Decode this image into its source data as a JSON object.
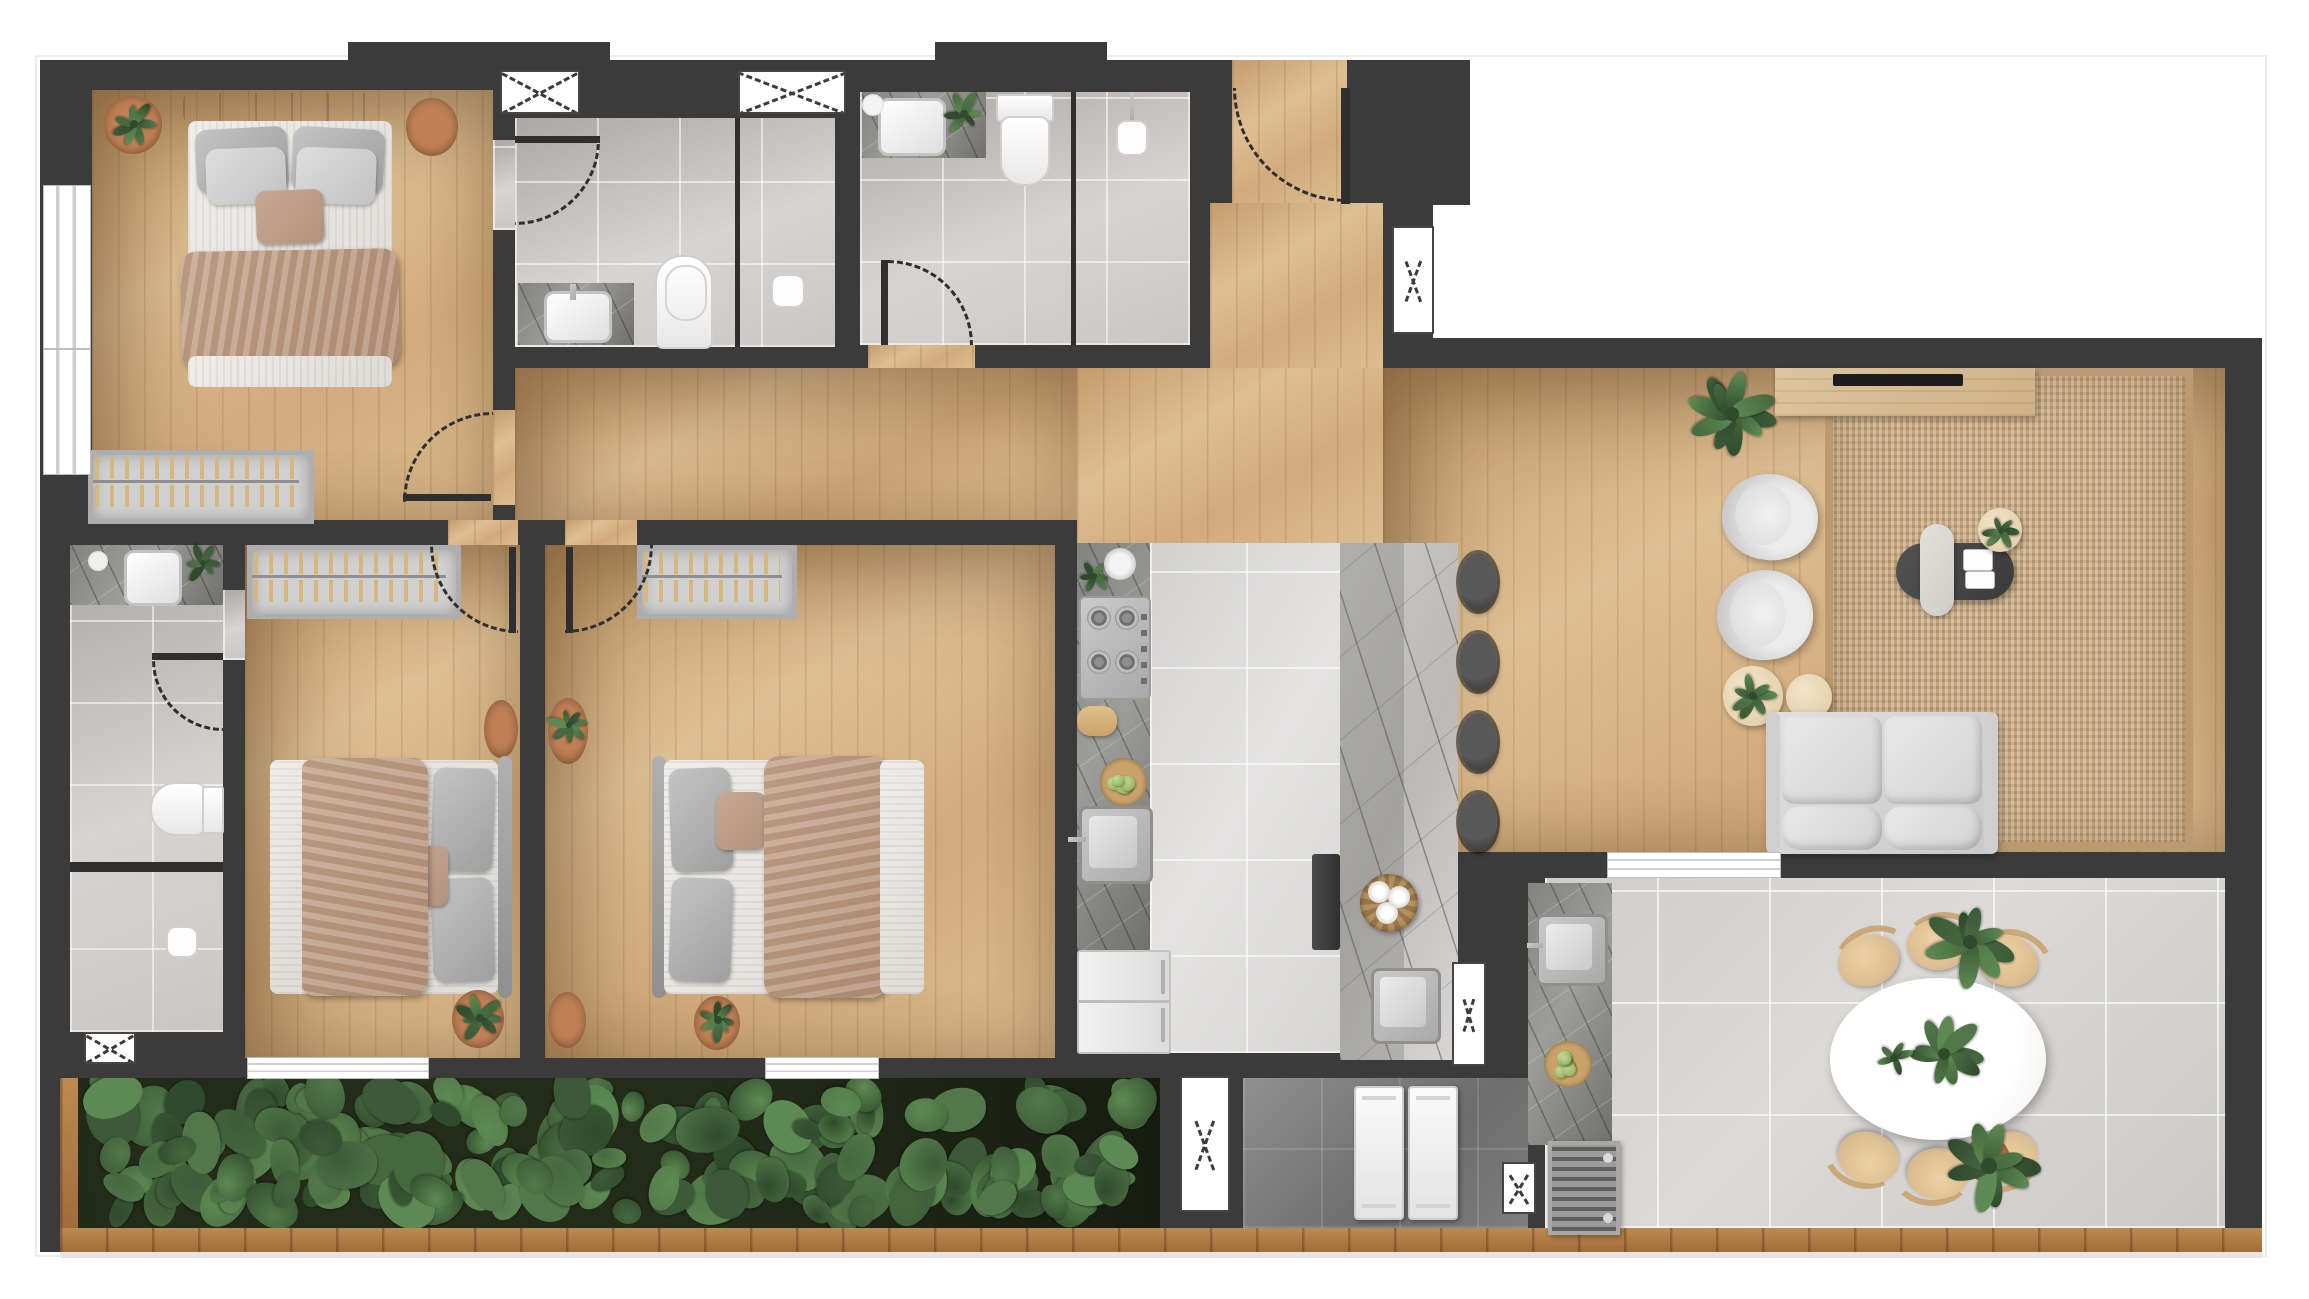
{
  "canvas": {
    "width": 2309,
    "height": 1299,
    "background": "#ffffff"
  },
  "palette": {
    "wall": "#3b3b3b",
    "exterior": "#ffffff",
    "wood_floor": "#d2ab7c",
    "bath_tile": "#cfccc9",
    "kitchen_tile": "#dcdbda",
    "terrace_tile": "#d5d3d0",
    "service_tile": "#7c7c7c",
    "counter_marble_dark": "#83837f",
    "island_marble_light": "#c9c8c6",
    "rug_jute": "#c4a57e",
    "rug_terracotta": "#b9794f",
    "upholstery_gray": "#d9d9d9",
    "blanket_tan": "#c0a18c",
    "foliage_green": "#4b6d45",
    "deck_wood": "#b0793f",
    "chair_wood": "#d9bc92",
    "window_symbol": "#ffffff",
    "door_symbol_dash": "#2e2e2e"
  },
  "rooms": {
    "master_bedroom": {
      "label": "Master Bedroom",
      "floor": "wood",
      "furniture": [
        "double-bed",
        "tufted-headboard",
        "4 pillows",
        "accent-pillow",
        "throw-blanket",
        "wardrobe-with-hangers",
        "round-rug-with-plant",
        "round-rug"
      ],
      "windows": 2
    },
    "ensuite_bathroom": {
      "label": "Ensuite Bathroom",
      "floor": "ceramic-tile",
      "furniture": [
        "vanity-counter",
        "basin",
        "toilet",
        "walk-in-shower",
        "glass-partition",
        "shower-head"
      ],
      "windows": 1
    },
    "guest_bathroom": {
      "label": "Guest Bathroom",
      "floor": "ceramic-tile",
      "furniture": [
        "vanity-counter",
        "basin",
        "round-mirror",
        "plant",
        "toilet",
        "walk-in-shower",
        "glass-partition",
        "hand-shower"
      ],
      "windows": 1
    },
    "entry": {
      "label": "Entry Vestibule",
      "floor": "wood",
      "furniture": [],
      "doors": [
        "main-entrance-swing"
      ]
    },
    "hallway": {
      "label": "Hallway",
      "floor": "wood",
      "furniture": []
    },
    "bedroom_2": {
      "label": "Bedroom 2",
      "floor": "wood",
      "furniture": [
        "single-bed",
        "pillows",
        "accent-pillow",
        "throw-blanket",
        "wardrobe-with-hangers",
        "round-rug-with-plant",
        "round-rug"
      ],
      "windows": 1
    },
    "bedroom_3": {
      "label": "Bedroom 3",
      "floor": "wood",
      "furniture": [
        "single-bed",
        "pillows",
        "accent-pillow",
        "throw-blanket",
        "wardrobe-with-hangers",
        "round-rug-with-plant",
        "round-rug",
        "round-rug-with-plant-south"
      ],
      "windows": 1
    },
    "bathroom_3": {
      "label": "Bathroom 3",
      "floor": "ceramic-tile",
      "furniture": [
        "vanity-counter",
        "basin",
        "tray",
        "plant",
        "toilet",
        "shower-enclosure",
        "shower-head"
      ],
      "windows": 1
    },
    "kitchen": {
      "label": "Kitchen",
      "floor": "large-format-tile",
      "furniture": [
        "counter-run-marble",
        "gas-cooktop-4-burner",
        "herb-plant",
        "bowl",
        "paper-towel-roll",
        "fruit-bowl",
        "counter-sink",
        "fridge-freezer",
        "island-marble",
        "island-sink",
        "towel-basket",
        "built-in-appliance",
        "bar-stools"
      ],
      "bar_stools": 4
    },
    "living_room": {
      "label": "Living Room",
      "floor": "wood",
      "furniture": [
        "jute-area-rug",
        "media-console",
        "tv",
        "large-plant",
        "armchair",
        "armchair",
        "round-side-table-with-plant",
        "round-side-table",
        "oval-coffee-table",
        "tray",
        "books",
        "side-table-with-plant",
        "three-seat-sofa"
      ],
      "armchairs": 2
    },
    "laundry": {
      "label": "Laundry / Service Area",
      "floor": "dark-tile",
      "furniture": [
        "washer",
        "dryer"
      ],
      "windows": 2
    },
    "terrace": {
      "label": "Gourmet Terrace",
      "floor": "large-format-tile",
      "furniture": [
        "bbq-counter-marble",
        "counter-sink",
        "fruit-bowl",
        "grill-vent-unit",
        "oval-dining-table",
        "dining-chairs",
        "table-plant-large",
        "table-plant-small",
        "potted-plant-northeast",
        "potted-plant-southeast"
      ],
      "dining_chairs": 6
    },
    "planter": {
      "label": "Planter Bed",
      "floor": "soil",
      "contents": "dense tropical foliage",
      "frame": "wood-deck-border"
    }
  },
  "symbols": {
    "window": "white box crossed by dashed X",
    "plain_window": "white sill band with mullion lines",
    "door": "dashed quarter-circle swing arc with dark door leaf"
  },
  "counts": {
    "bedrooms": 3,
    "bathrooms": 3,
    "beds": 3,
    "wardrobes": 3,
    "dining_chairs": 6,
    "bar_stools": 4,
    "armchairs": 2,
    "x_windows": 7,
    "plain_windows": 5,
    "door_arcs": 7,
    "plants": 14
  },
  "decor": {
    "planter_leaf_count": 170,
    "foliage_colors": [
      "#3c5a38",
      "#46683f",
      "#52784a",
      "#2f4a2c",
      "#5d8a52"
    ],
    "fruit_color": "#9fbf6a",
    "hanger_color": "#d8b77e"
  }
}
